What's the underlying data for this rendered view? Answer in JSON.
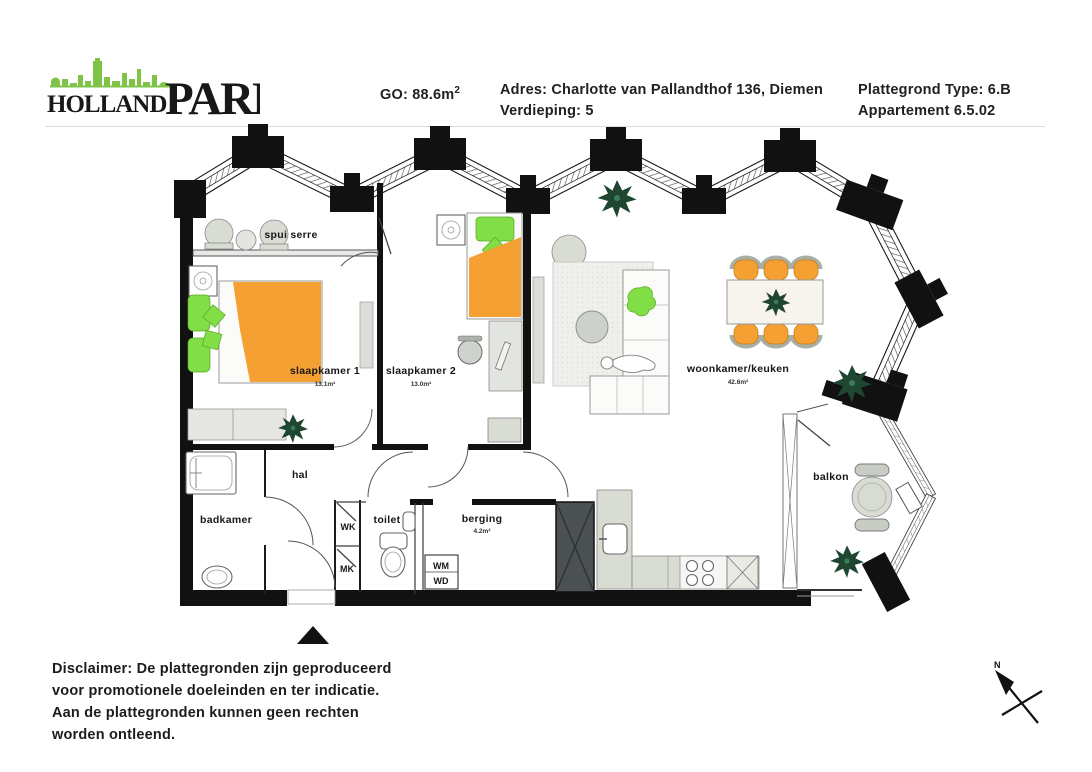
{
  "header": {
    "logo": {
      "word1": "HOLLAND",
      "word2": "PARK"
    },
    "go_label": "GO: 88.6m",
    "go_sup": "2",
    "address": "Adres: Charlotte van Pallandthof 136, Diemen",
    "floor": "Verdieping: 5",
    "plan_type": "Plattegrond Type: 6.B",
    "apartment": "Appartement 6.5.02"
  },
  "plan": {
    "rooms": {
      "spui_serre": {
        "label": "spui serre"
      },
      "slaapkamer1": {
        "label": "slaapkamer 1",
        "area": "13.1m²"
      },
      "slaapkamer2": {
        "label": "slaapkamer 2",
        "area": "13.0m²"
      },
      "woonkamer": {
        "label": "woonkamer/keuken",
        "area": "42.6m²"
      },
      "hal": {
        "label": "hal"
      },
      "badkamer": {
        "label": "badkamer"
      },
      "wk": {
        "label": "WK"
      },
      "mk": {
        "label": "MK"
      },
      "toilet": {
        "label": "toilet"
      },
      "berging": {
        "label": "berging",
        "area": "4.2m²"
      },
      "wm": {
        "label": "WM"
      },
      "wd": {
        "label": "WD"
      },
      "balkon": {
        "label": "balkon"
      }
    },
    "compass": {
      "label": "N"
    }
  },
  "footer": {
    "line1": "Disclaimer: De plattegronden zijn geproduceerd",
    "line2": "voor promotionele doeleinden en ter indicatie.",
    "line3": "Aan de plattegronden kunnen geen rechten",
    "line4": "worden ontleend."
  },
  "colors": {
    "furniture_orange": "#F5A033",
    "accent_green": "#82DE46",
    "plant_green": "#1E4631",
    "logo_green": "#7FC347",
    "wall_black": "#111111",
    "counter_gray": "#D8DCD2",
    "shaft_gray": "#4A5053"
  }
}
